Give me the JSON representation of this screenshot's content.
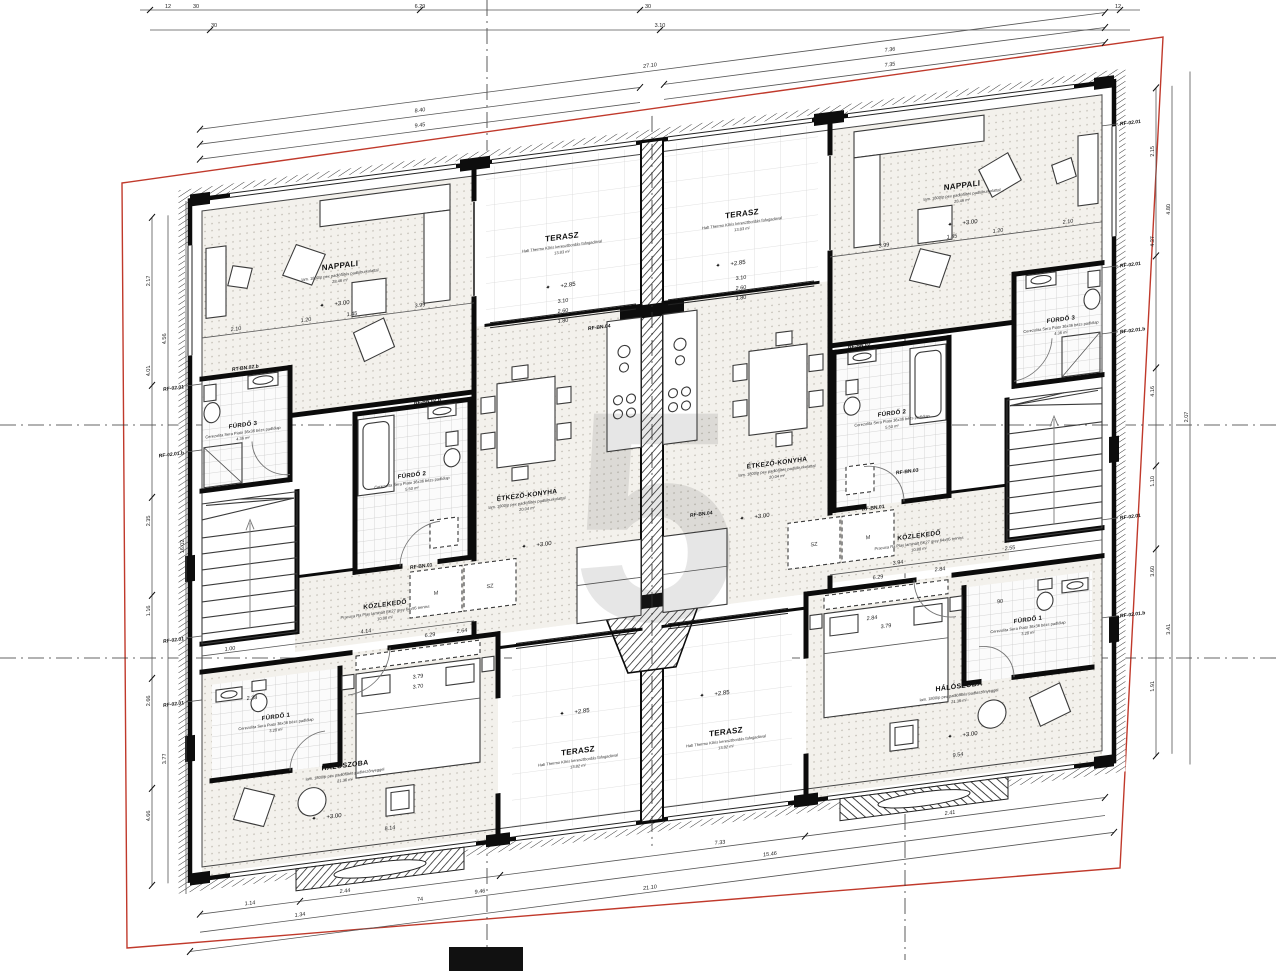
{
  "rooms": {
    "nappali": {
      "name": "NAPPALI",
      "sub": "lam. 1800/p pex padlófűtés padlóburkolattal",
      "area": "28.46 m²"
    },
    "terasz_top": {
      "name": "TERASZ",
      "sub": "Hab Thermo Kőris keresztbordás fafogadóval",
      "area": "13.83 m²"
    },
    "terasz_bottom": {
      "name": "TERASZ",
      "sub": "Hab Thermo Kőris keresztbordás fafogadóval",
      "area": "13.82 m²"
    },
    "etkezo": {
      "name": "ÉTKEZŐ-KONYHA",
      "sub": "lam. 1800/p pex padlófűtés padlóburkolattal",
      "area": "20.04 m²"
    },
    "kozlekedo": {
      "name": "KÖZLEKEDŐ",
      "sub": "Pracusa Ra Play laminált BK27 grey 64x95 treniss",
      "area": "10.88 m²"
    },
    "halo": {
      "name": "HÁLÓSZOBA",
      "sub": "lam. 1800/p pex padlófűtés padlószőnyeggel",
      "area": "21.36 m²"
    },
    "furdo1": {
      "name": "FÜRDŐ 1",
      "sub": "Cerezolita Sera Piato 36x36 bézs padlólap",
      "area": "3.28 m²"
    },
    "furdo2": {
      "name": "FÜRDŐ 2",
      "sub": "Cerezolita Sera Piato 36x36 bézs padlólap",
      "area": "5.50 m²"
    },
    "furdo3": {
      "name": "FÜRDŐ 3",
      "sub": "Cerezolita Sera Piato 36x36 bézs padlólap",
      "area": "4.36 m²"
    }
  },
  "levels": {
    "interior": "+3.00",
    "terrace": "+2.85"
  },
  "icons": {
    "level_star": "✦"
  },
  "wardrobe": {
    "m": "M",
    "sz": "SZ"
  },
  "refs": {
    "rf0201": "RF-02.01",
    "rf0201b": "RF-02.01.b",
    "rtbn02": "RT-BN.02.b",
    "rfbn01": "RF-BN.01",
    "rfbn02": "RF-BN.02",
    "rfbn02b": "RF-BN.02.b",
    "rfbn03": "RF-BN.03",
    "rfbn04": "RF-BN.04"
  },
  "dims": {
    "top": [
      "27.10",
      "8.40",
      "9.45",
      "7.36",
      "7.35"
    ],
    "top_outer": [
      "12",
      "30",
      "6.29",
      "30",
      "12",
      "3.10",
      "30"
    ],
    "left": [
      "2.17",
      "4.01",
      "2.35",
      "1.16",
      "2.66",
      "4.66",
      "4.56",
      "3.77",
      "16.02"
    ],
    "right": [
      "2.15",
      "4.27",
      "4.16",
      "1.10",
      "3.60",
      "1.91",
      "4.80",
      "3.41",
      "2.07"
    ],
    "bottom": [
      "1.14",
      "2.44",
      "7.33",
      "2.41",
      "1.34",
      "74",
      "15.46",
      "21.10",
      "9.46"
    ],
    "interior": [
      "2.10",
      "1.20",
      "1.45",
      "3.99",
      "3.10",
      "2.60",
      "1.80",
      "1.00",
      "4.14",
      "6.29",
      "3.94",
      "2.55",
      "2.84",
      "2.38",
      "3.79",
      "3.70",
      "8.14",
      "9.54",
      "2.64",
      "90"
    ]
  }
}
